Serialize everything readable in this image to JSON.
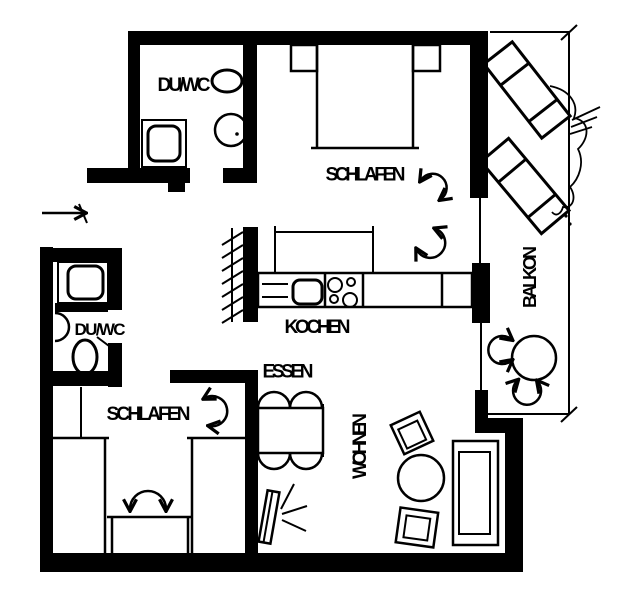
{
  "title": "apartment-floor-plan",
  "colors": {
    "ink": "#000000",
    "paper": "#ffffff"
  },
  "rooms": [
    {
      "id": "duwc-top",
      "label": "DU/WC",
      "fixtures": [
        "toilet",
        "washbasin",
        "shower-tray"
      ]
    },
    {
      "id": "schlafen-top",
      "label": "SCHLAFEN",
      "fixtures": [
        "double-bed",
        "nightstand",
        "nightstand",
        "swing-arrow",
        "swing-arrow"
      ]
    },
    {
      "id": "kochen",
      "label": "KOCHEN",
      "fixtures": [
        "tall-cabinet",
        "worktop",
        "sink-basin",
        "cooktop-4-burners",
        "duct-hatch"
      ]
    },
    {
      "id": "essen",
      "label": "ESSEN",
      "fixtures": [
        "dining-table",
        "chair",
        "chair",
        "chair",
        "chair"
      ]
    },
    {
      "id": "duwc-bottom",
      "label": "DU/WC",
      "fixtures": [
        "shower-tray",
        "washbasin",
        "toilet",
        "door-leaf"
      ]
    },
    {
      "id": "schlafen-bottom",
      "label": "SCHLAFEN",
      "fixtures": [
        "wardrobe",
        "wardrobe",
        "bed",
        "swing-arrow",
        "swing-arrow"
      ]
    },
    {
      "id": "wohnen",
      "label": "WOHNEN",
      "fixtures": [
        "armchair",
        "armchair",
        "round-table",
        "sofa",
        "tv-with-rays"
      ]
    },
    {
      "id": "balkon",
      "label": "BALKON",
      "fixtures": [
        "lounger",
        "lounger",
        "plant",
        "round-table",
        "swing-arrow",
        "swing-arrow"
      ]
    }
  ],
  "entrance": {
    "symbol": "entry-arrow"
  }
}
